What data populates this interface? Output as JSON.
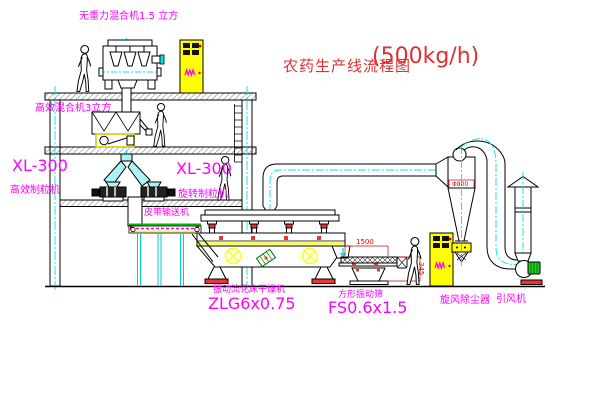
{
  "title": {
    "name": "农药生产线流程图",
    "capacity": "(500kg/h)"
  },
  "labels": {
    "top_mixer": "无重力混合机1.5 立方",
    "second_mixer": "高效混合机3立方",
    "left_granulator_model": "XL-300",
    "left_granulator_name": "高效制粒机",
    "mid_granulator_model": "XL-300",
    "mid_granulator_name": "旋转制粒机",
    "belt_conveyor": "皮带输送机",
    "dryer_name": "振动流化床干燥机",
    "dryer_model": "ZLG6x0.75",
    "screen_name": "方形振动筛",
    "screen_model": "FS0.6x1.5",
    "cyclone": "旋风除尘器",
    "fan": "引风机"
  },
  "dimensions": {
    "screen_length": "1500",
    "screen_height": "345",
    "cyclone_note": "Φ800"
  },
  "colors": {
    "label": "#FF00FF",
    "title": "#E03030",
    "line": "#000000",
    "centerline": "#00FFFF",
    "highlight": "#FFFF00",
    "accent_green": "#00BB00",
    "accent_red": "#EE3333"
  }
}
